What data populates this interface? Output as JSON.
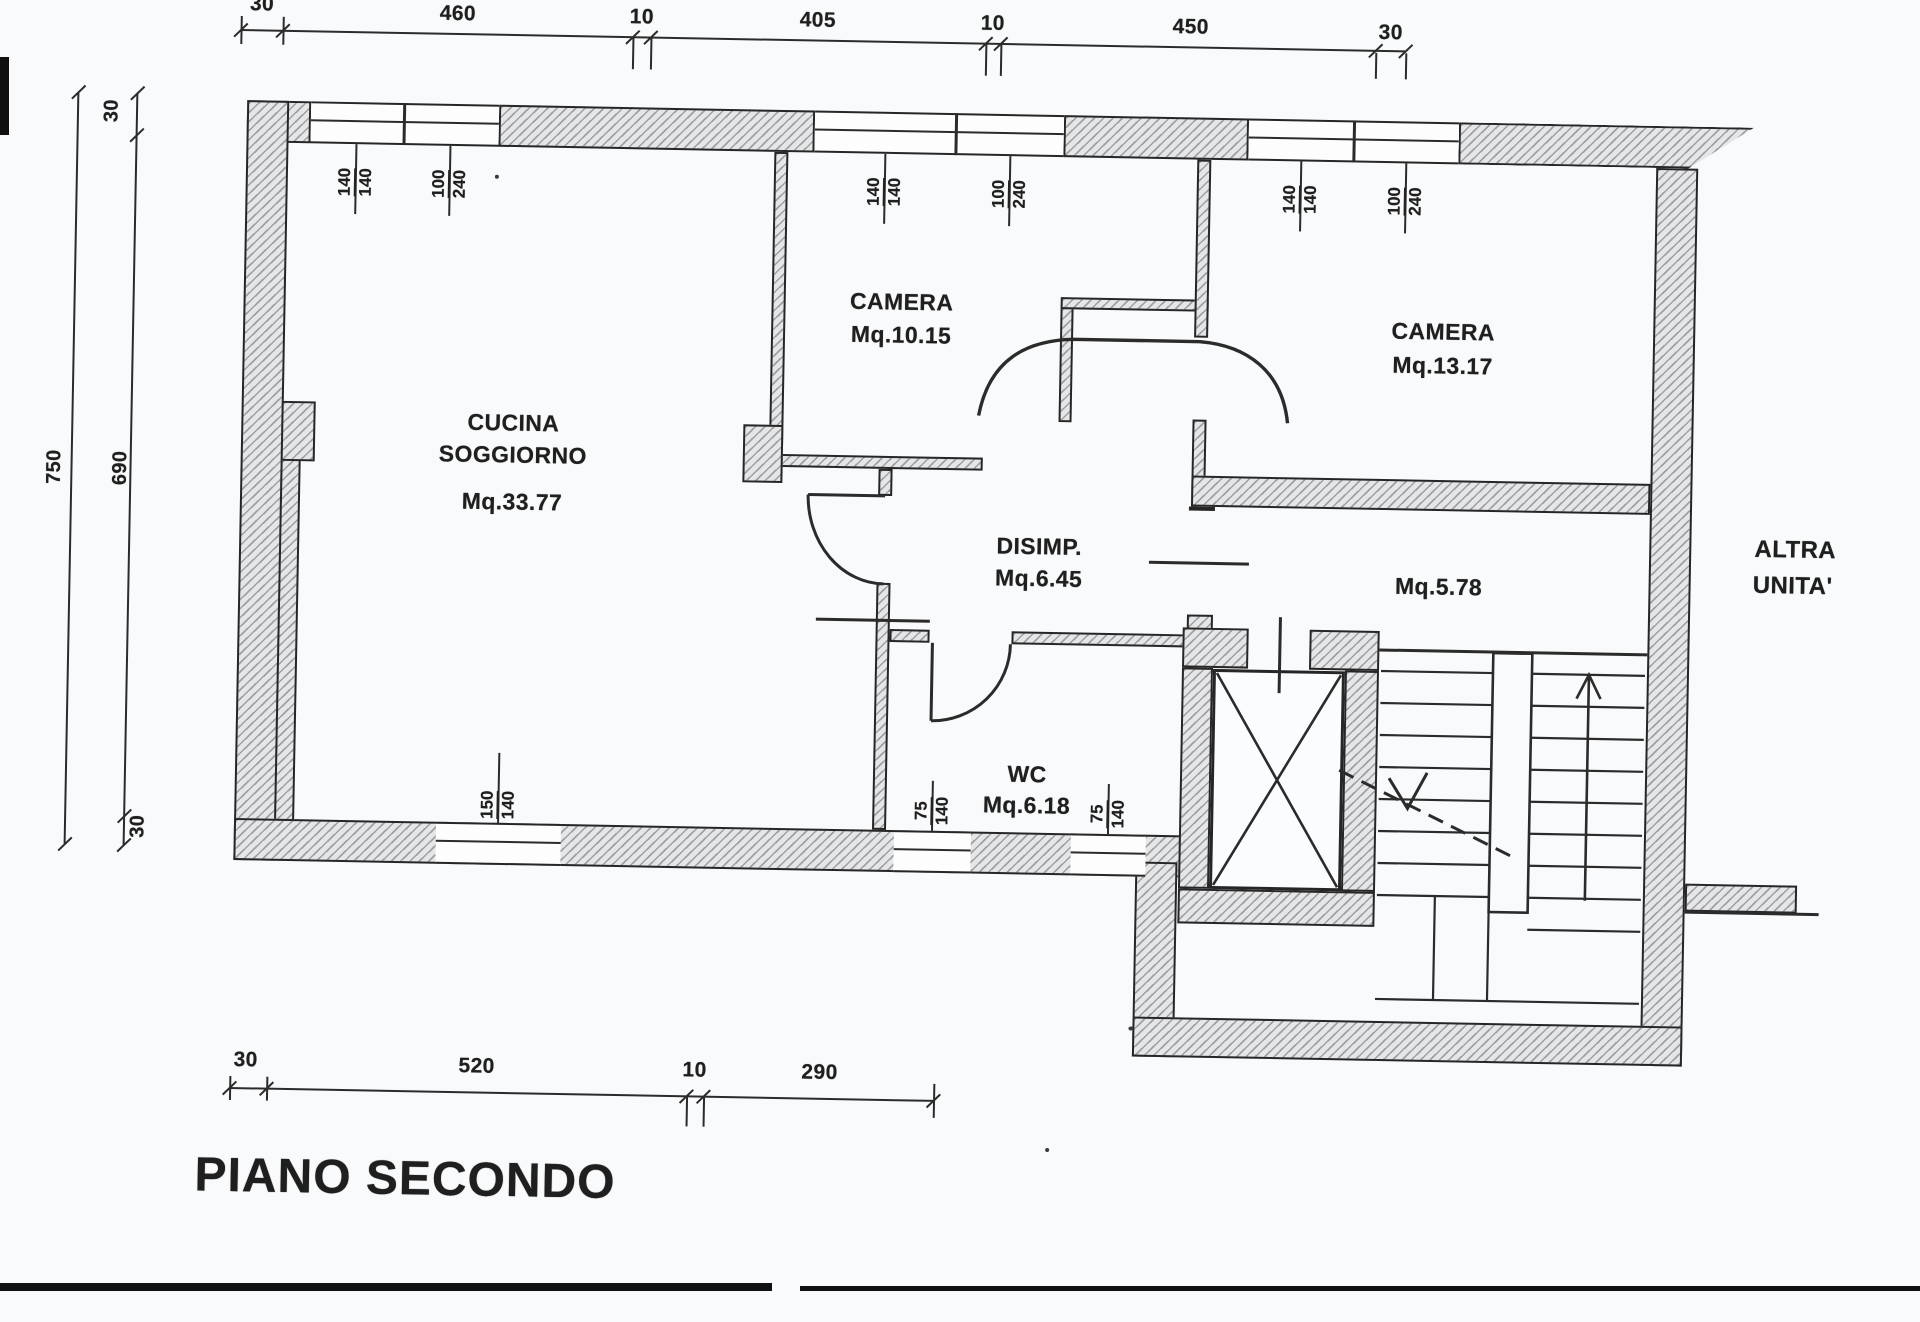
{
  "title": "PIANO SECONDO",
  "rooms": {
    "cucina": {
      "name1": "CUCINA",
      "name2": "SOGGIORNO",
      "area": "Mq.33.77"
    },
    "camera1": {
      "name": "CAMERA",
      "area": "Mq.10.15"
    },
    "camera2": {
      "name": "CAMERA",
      "area": "Mq.13.17"
    },
    "disimp": {
      "name": "DISIMP.",
      "area": "Mq.6.45"
    },
    "wc": {
      "name": "WC",
      "area": "Mq.6.18"
    },
    "landing": {
      "area": "Mq.5.78"
    },
    "neighbor": {
      "line1": "ALTRA",
      "line2": "UNITA'"
    }
  },
  "dims": {
    "top": [
      "30",
      "460",
      "10",
      "405",
      "10",
      "450",
      "30"
    ],
    "bottom": [
      "30",
      "520",
      "10",
      "290"
    ],
    "left": {
      "total": "750",
      "upper": "30",
      "inner": "690",
      "lower": "30"
    }
  },
  "windows": {
    "cucina_w1": {
      "w": "140",
      "h": "140"
    },
    "cucina_w2": {
      "w": "100",
      "h": "240"
    },
    "camera1_w1": {
      "w": "140",
      "h": "140"
    },
    "camera1_w2": {
      "w": "100",
      "h": "240"
    },
    "camera2_w1": {
      "w": "140",
      "h": "140"
    },
    "camera2_w2": {
      "w": "100",
      "h": "240"
    },
    "soggiorno_w": {
      "w": "150",
      "h": "140"
    },
    "wc_w1": {
      "w": "75",
      "h": "140"
    },
    "wc_w2": {
      "w": "75",
      "h": "140"
    }
  },
  "colors": {
    "line": "#2b2b2b",
    "paper": "#f9fafb",
    "hatch_dark": "#6e6e70",
    "hatch_light": "#e9eaec"
  }
}
